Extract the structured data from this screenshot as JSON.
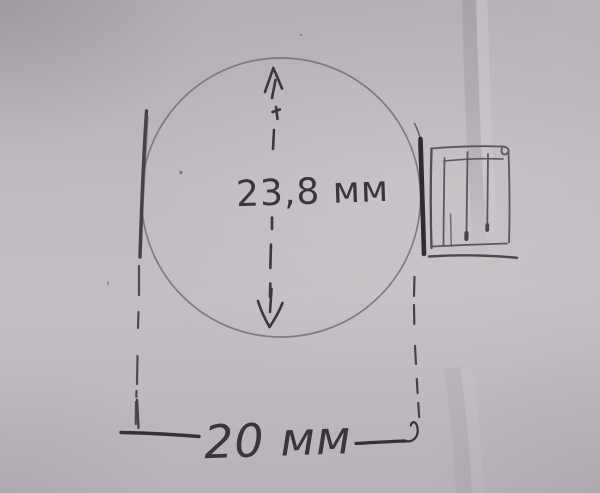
{
  "sketch": {
    "diameter_label": "23,8 мм",
    "width_label": "20 мм"
  },
  "colors": {
    "paper": "#bdb8bd",
    "pencil_light": "#7b767c",
    "pencil_dark": "#3a373b"
  }
}
